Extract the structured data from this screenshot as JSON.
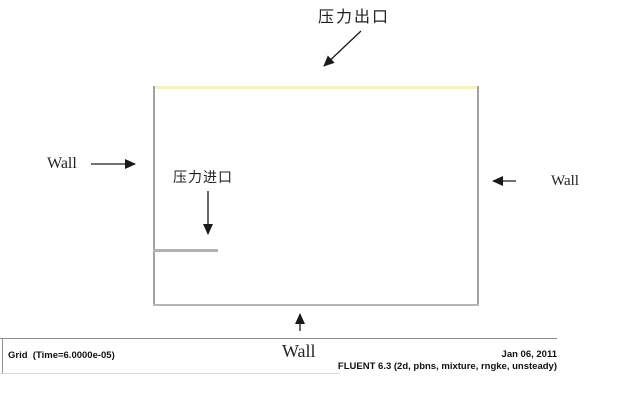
{
  "window": {
    "app": "FLUENT graphics window",
    "width_px": 640,
    "height_px": 400,
    "background": "#ffffff"
  },
  "domain_labels": {
    "pressure_outlet": "压力出口",
    "pressure_inlet": "压力进口",
    "wall_left": "Wall",
    "wall_right": "Wall",
    "wall_bottom": "Wall"
  },
  "status_bar": {
    "plot_title": "Grid  (Time=6.0000e-05)",
    "date": "Jan 06, 2011",
    "solver_info": "FLUENT 6.3 (2d, pbns, mixture, rngke, unsteady)"
  },
  "colors": {
    "pressure_outlet_edge": "#f5f5b0",
    "wall_edge": "#a3a3a3",
    "wall_bottom_edge": "#b5b5b5",
    "pressure_inlet_edge": "#b2b2b2",
    "annotation_text": "#222222",
    "arrow": "#1a1a1a",
    "status_bar_line": "#8f8f8f"
  }
}
